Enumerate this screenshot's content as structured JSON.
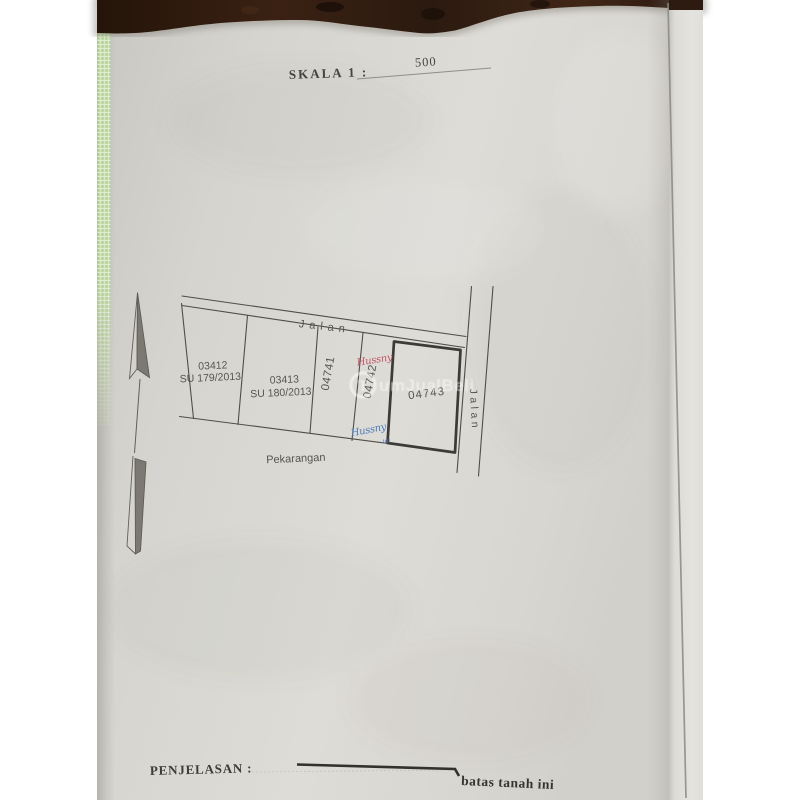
{
  "document": {
    "scale": {
      "label": "SKALA 1 :",
      "value": "500"
    },
    "legend": {
      "label": "PENJELASAN :",
      "symbol_meaning": "batas tanah ini"
    }
  },
  "map": {
    "roads": {
      "top": "Jalan",
      "right": "Jalan"
    },
    "area_label": "Pekarangan",
    "parcels": [
      {
        "number": "03412",
        "surat_ukur": "SU 179/2013"
      },
      {
        "number": "03413",
        "surat_ukur": "SU 180/2013"
      },
      {
        "number": "04741",
        "surat_ukur": ""
      },
      {
        "number": "04742",
        "surat_ukur": ""
      },
      {
        "number": "04743",
        "surat_ukur": ""
      }
    ],
    "handwritten_annotations": [
      {
        "color": "red",
        "text": "Hussny"
      },
      {
        "color": "blue",
        "text": "Hussny"
      },
      {
        "color": "blue",
        "text": "im"
      }
    ]
  },
  "watermark": {
    "logo_letter": "T",
    "text": "umJualBeli"
  },
  "colors": {
    "paper": "#d6d5d0",
    "wood_background": "#2d1a10",
    "binder_edge_green": "#c0d9a6",
    "map_ink": "#4c4a46",
    "heading_ink": "#3e3c37",
    "red_annotation": "#c25767",
    "blue_annotation": "#4e7dbd",
    "watermark_white": "#ffffff"
  }
}
